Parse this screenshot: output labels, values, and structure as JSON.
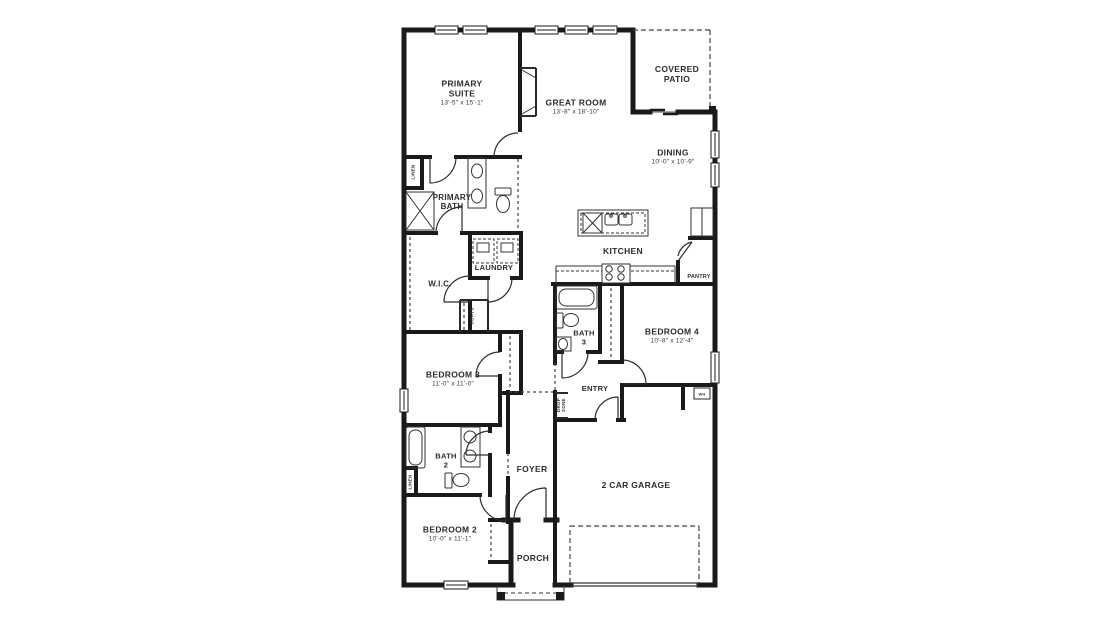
{
  "colors": {
    "wall": "#1a1a1a",
    "text": "#2d2d2d",
    "background": "#ffffff"
  },
  "rooms": {
    "primary_suite": {
      "name": "PRIMARY SUITE",
      "dims": "13'-5\" x 15'-1\""
    },
    "great_room": {
      "name": "GREAT ROOM",
      "dims": "13'-8\" x 18'-10\""
    },
    "covered_patio": {
      "name": "COVERED PATIO"
    },
    "dining": {
      "name": "DINING",
      "dims": "10'-0\" x 10'-9\""
    },
    "primary_bath": {
      "name": "PRIMARY BATH"
    },
    "wic": {
      "name": "W.I.C."
    },
    "laundry": {
      "name": "LAUNDRY"
    },
    "kitchen": {
      "name": "KITCHEN"
    },
    "pantry": {
      "name": "PANTRY"
    },
    "bath_3": {
      "name": "BATH 3"
    },
    "bedroom_4": {
      "name": "BEDROOM 4",
      "dims": "10'-8\" x 12'-4\""
    },
    "entry": {
      "name": "ENTRY"
    },
    "bedroom_3": {
      "name": "BEDROOM 3",
      "dims": "11'-0\" x 11'-0\""
    },
    "bath_2": {
      "name": "BATH 2"
    },
    "foyer": {
      "name": "FOYER"
    },
    "garage": {
      "name": "2 CAR GARAGE"
    },
    "bedroom_2": {
      "name": "BEDROOM 2",
      "dims": "10'-0\" x 11'-1\""
    },
    "porch": {
      "name": "PORCH"
    }
  },
  "closet_labels": {
    "linen": "LINEN",
    "coats": "COATS",
    "drop_zone": "DROP ZONE",
    "water_heater": "WH"
  }
}
